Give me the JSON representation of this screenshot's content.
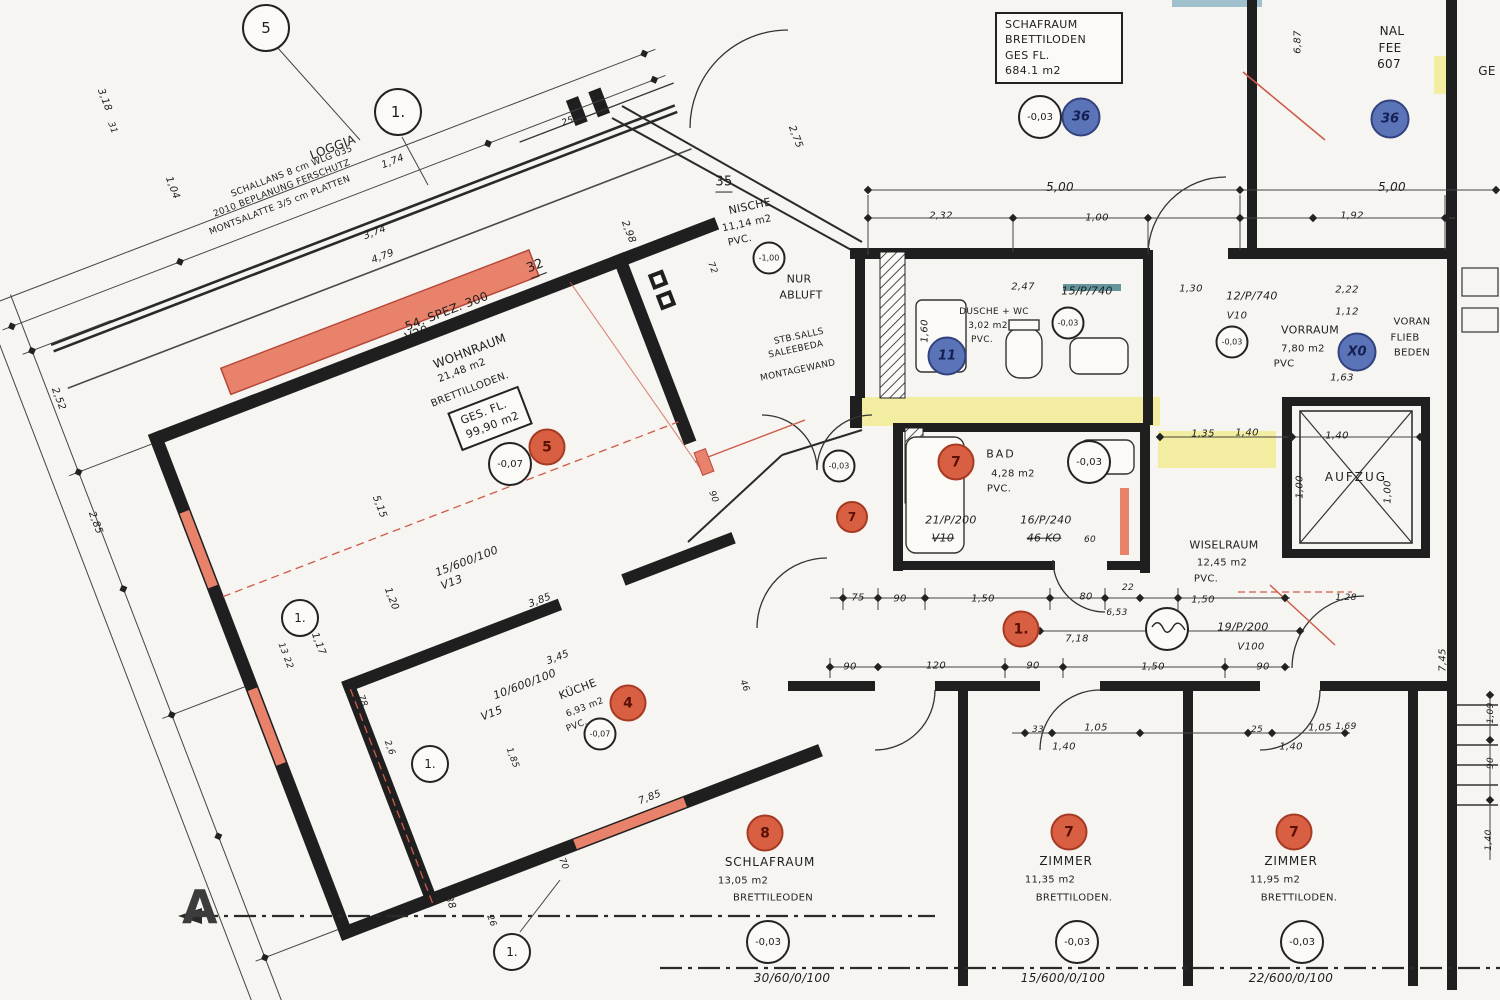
{
  "colors": {
    "paper": "#f6f5f1",
    "ink": "#1e1e1e",
    "wall_fill_salmon": "#e8826b",
    "wall_accent_red": "#cf5a48",
    "corridor_yellow": "#f2eda0",
    "badge_red": "#d95f43",
    "badge_blue": "#5b74b8"
  },
  "grid": {
    "b5": "5",
    "b1": "1.",
    "b2": "1.",
    "b3": "1.",
    "b4": "1.",
    "axis_a": "A"
  },
  "loggia": {
    "title": "LOGGIA",
    "note1": "SCHALLANS  8 cm WLG 035",
    "note2": "2010 BEPLANUNG FERSCHUTZ",
    "note3": "MONTSALATTE 3/5 cm PLATTEN",
    "win": "32"
  },
  "wohnraum": {
    "spez": "54. SPEZ. 300",
    "v": "V20",
    "name": "WOHNRAUM",
    "area": "21,48 m2",
    "floor": "BRETTILLODEN.",
    "ges_l1": "GES. FL.",
    "ges_l2": "99,90 m2",
    "elev": "-0,07",
    "badge": "5",
    "win_code": "15/600/100",
    "win_v": "V13",
    "win_dim": "3,85"
  },
  "kueche": {
    "win_code": "10/600/100",
    "win_v": "V15",
    "win_dim": "3,45",
    "name": "KÜCHE",
    "area": "6,93 m2",
    "floor": "PVC.",
    "elev": "-0,07",
    "badge": "4"
  },
  "schaf_box": {
    "l1": "SCHAFRAUM",
    "l2": "BRETTILODEN",
    "l3": "GES FL.",
    "l4": "684.1 m2",
    "elev": "-0,03",
    "badge": "36"
  },
  "top_right": {
    "l1": "NAL",
    "l2": "FEE",
    "l3": "607",
    "badge": "36",
    "frag": "GE"
  },
  "nische": {
    "win": "35",
    "name": "NISCHE",
    "area": "11,14 m2",
    "floor": "PVC.",
    "elev": "-1,00"
  },
  "notes": {
    "abluft1": "NUR",
    "abluft2": "ABLUFT",
    "stb1": "STB.SALLS",
    "stb2": "SALEEBEDA",
    "mont": "MONTAGEWAND"
  },
  "dusche": {
    "l1": "DUSCHE + WC",
    "l2": "3,02 m2",
    "l3": "PVC.",
    "badge": "11"
  },
  "bad": {
    "name": "BAD",
    "area": "4,28 m2",
    "floor": "PVC.",
    "elev": "-0,03",
    "badge": "7",
    "door1": "21/P/200",
    "door1v": "V10",
    "door2": "16/P/240",
    "door2v": "46 KO"
  },
  "corr": {
    "badge7": "7",
    "elev7": "-0,03",
    "badge1": "1.",
    "door19": "19/P/200",
    "door19v": "V100"
  },
  "doors_top": {
    "d15": "15/P/740",
    "d15e": "-0,03",
    "d12": "12/P/740",
    "d12v": "V10",
    "d12e": "-0,03"
  },
  "vorraum": {
    "name": "VORRAUM",
    "area": "7,80 m2",
    "floor": "PVC",
    "badge": "X0"
  },
  "voran": {
    "l1": "VORAN",
    "l2": "FLIEB",
    "l3": "BEDEN"
  },
  "aufzug": {
    "name": "AUFZUG",
    "d_top": "1,40",
    "d_left": "1,00",
    "d_right": "1,00"
  },
  "wisel": {
    "name": "WISELRAUM",
    "area": "12,45 m2",
    "floor": "PVC."
  },
  "rooms": [
    {
      "badge": "8",
      "name": "SCHLAFRAUM",
      "area": "13,05 m2",
      "floor": "BRETTILEODEN",
      "elev": "-0,03",
      "axis": "30/60/0/100"
    },
    {
      "badge": "7",
      "name": "ZIMMER",
      "area": "11,35 m2",
      "floor": "BRETTILODEN.",
      "elev": "-0,03",
      "axis": "15/600/0/100"
    },
    {
      "badge": "7",
      "name": "ZIMMER",
      "area": "11,95 m2",
      "floor": "BRETTILODEN.",
      "elev": "-0,03",
      "axis": "22/600/0/100"
    }
  ],
  "dims": {
    "top": [
      "5,00",
      "2,32",
      "1,00",
      "1,92",
      "5,00"
    ],
    "right": [
      "6,87",
      "2,22",
      "1,12",
      "1,63",
      "1,30",
      "2,47",
      "1,60",
      "7,45",
      "1,28",
      "1,69",
      "1,09",
      "90",
      "1,40"
    ],
    "corr_top": [
      "75",
      "90",
      "1,50",
      "80",
      "22",
      "1,50"
    ],
    "corr_mid": [
      "6,53",
      "7,18"
    ],
    "corr_bot": [
      "90",
      "120",
      "90",
      "1,50",
      "90"
    ],
    "lower": [
      "33",
      "1,05",
      "1,40",
      "25",
      "1,40",
      "1,05"
    ],
    "corr2": [
      "1,35",
      "1,40"
    ],
    "rot_top": [
      "1,74",
      "3,74",
      "4,79",
      "3,18",
      "31",
      "1,04",
      "2,98",
      "2,75",
      "72",
      "25"
    ],
    "rot_left": [
      "2,52",
      "2,85",
      "5,15",
      "1,20",
      "1,17",
      "13 22",
      "78",
      "2,6",
      "1,38",
      "26",
      "70",
      "7,85",
      "1,85",
      "90",
      "46"
    ],
    "misc": [
      "60"
    ]
  }
}
